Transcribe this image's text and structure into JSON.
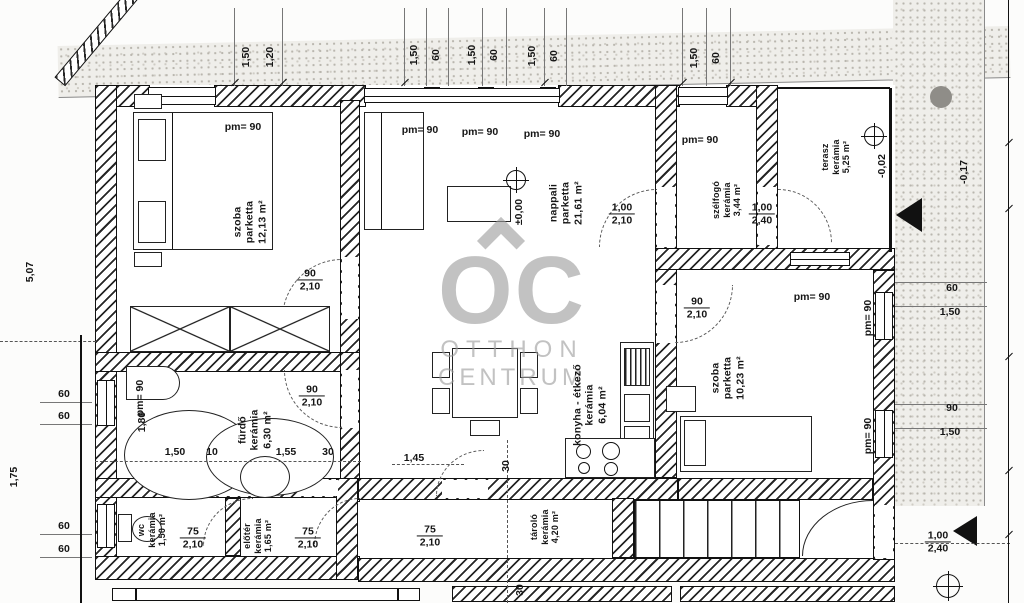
{
  "watermark": {
    "logo": "OC",
    "word1": "OTTHON",
    "word2": "CENTRUM"
  },
  "rooms": {
    "szoba1": {
      "name": "szoba",
      "floor": "parketta",
      "area": "12,13 m²"
    },
    "nappali": {
      "name": "nappali",
      "floor": "parketta",
      "area": "21,61 m²"
    },
    "szelfogo": {
      "name": "szélfogó",
      "floor": "kerámia",
      "area": "3,44 m²"
    },
    "terasz": {
      "name": "terasz",
      "floor": "kerámia",
      "area": "5,25 m²"
    },
    "konyha": {
      "name": "konyha - étkező",
      "floor": "kerámia",
      "area": "6,04 m²"
    },
    "furdo": {
      "name": "fürdő",
      "floor": "kerámia",
      "area": "6,30 m²"
    },
    "szoba2": {
      "name": "szoba",
      "floor": "parketta",
      "area": "10,23 m²"
    },
    "wc": {
      "name": "wc",
      "floor": "kerámia",
      "area": "1,50 m²"
    },
    "eloter": {
      "name": "előtér",
      "floor": "kerámia",
      "area": "1,65 m²"
    },
    "tarolo": {
      "name": "tároló",
      "floor": "kerámia",
      "area": "4,20 m²"
    }
  },
  "levels": {
    "main": "±0,00",
    "terasz": "-0,02",
    "terrain": "-0,17"
  },
  "pm": "pm= 90",
  "doors": {
    "szoba1": {
      "w": "90",
      "h": "2,10"
    },
    "furdo": {
      "w": "90",
      "h": "2,10"
    },
    "szoba2": {
      "w": "90",
      "h": "2,10"
    },
    "nappali_szelfogo": {
      "w": "1,00",
      "h": "2,10"
    },
    "szelfogo_terasz": {
      "w": "1,00",
      "h": "2,40"
    },
    "wc": {
      "w": "75",
      "h": "2,10"
    },
    "eloter": {
      "w": "75",
      "h": "2,10"
    },
    "tarolo": {
      "w": "75",
      "h": "2,10"
    },
    "terasz_entry": {
      "w": "1,00",
      "h": "2,40"
    }
  },
  "dims": {
    "top": [
      "1,50",
      "1,20",
      "1,50",
      "60",
      "1,50",
      "60",
      "1,50",
      "60",
      "1,50",
      "60"
    ],
    "left": [
      "5,07",
      "60",
      "60",
      "1,75",
      "60",
      "60"
    ],
    "right": [
      "60",
      "1,50",
      "90",
      "1,50"
    ],
    "bath": [
      "1,80",
      "1,50",
      "10",
      "1,55",
      "30"
    ],
    "misc": [
      "1,45",
      "30",
      "30"
    ]
  }
}
